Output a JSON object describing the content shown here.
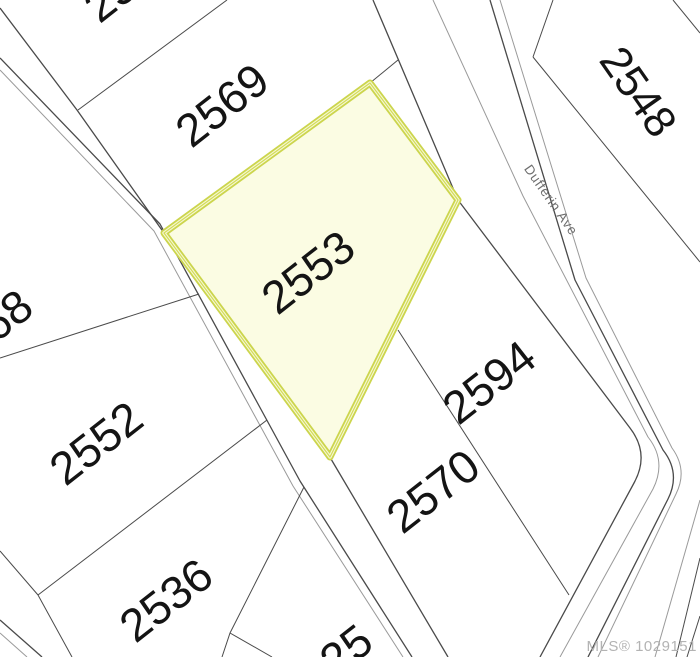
{
  "map": {
    "type": "mls-plat-map",
    "watermark": {
      "text": "MLS® 1029151"
    },
    "street": {
      "name": "Dufferin Ave"
    },
    "highlight": {
      "label": "2553",
      "fill": "#FBFCE3",
      "border": "#CCD54D"
    },
    "parcels": {
      "top_partial": {
        "label": "25"
      },
      "p2569": {
        "label": "2569"
      },
      "p2548": {
        "label": "2548"
      },
      "p2568": {
        "label": "2568"
      },
      "p2594": {
        "label": "2594"
      },
      "p2552": {
        "label": "2552"
      },
      "p2570": {
        "label": "2570"
      },
      "p2536": {
        "label": "2536"
      },
      "bottom_partial": {
        "label": "25"
      }
    },
    "colors": {
      "boundary_line": "#4a4a4a",
      "secondary_line": "#9a9a9a",
      "background": "#ffffff",
      "label_text": "#141414",
      "street_text": "#6e6e6e",
      "watermark_text": "#b3b3b3"
    }
  }
}
